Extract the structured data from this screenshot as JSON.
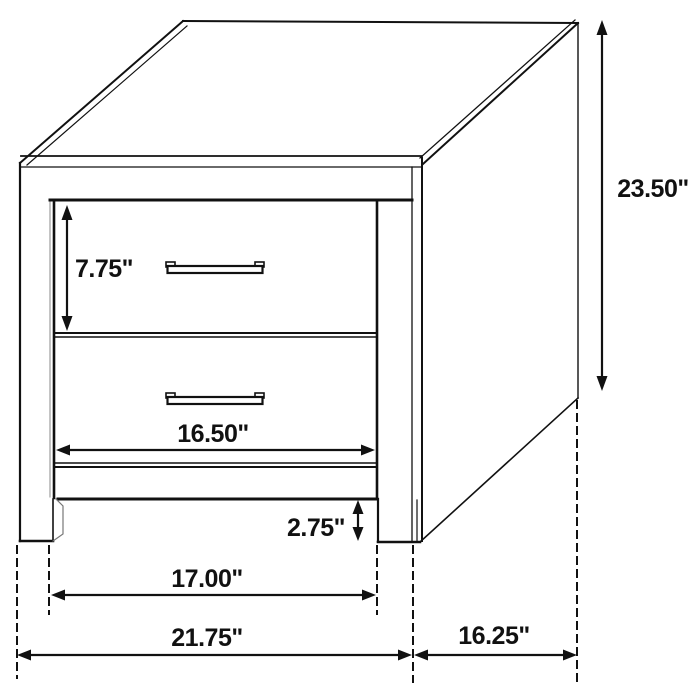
{
  "dimensions": {
    "drawer_height": "7.75\"",
    "drawer_opening_width": "16.50\"",
    "overall_height": "23.50\"",
    "base_clearance_height": "2.75\"",
    "inner_leg_span": "17.00\"",
    "overall_width": "21.75\"",
    "overall_depth": "16.25\""
  },
  "colors": {
    "line": "#111111",
    "background": "#ffffff"
  }
}
